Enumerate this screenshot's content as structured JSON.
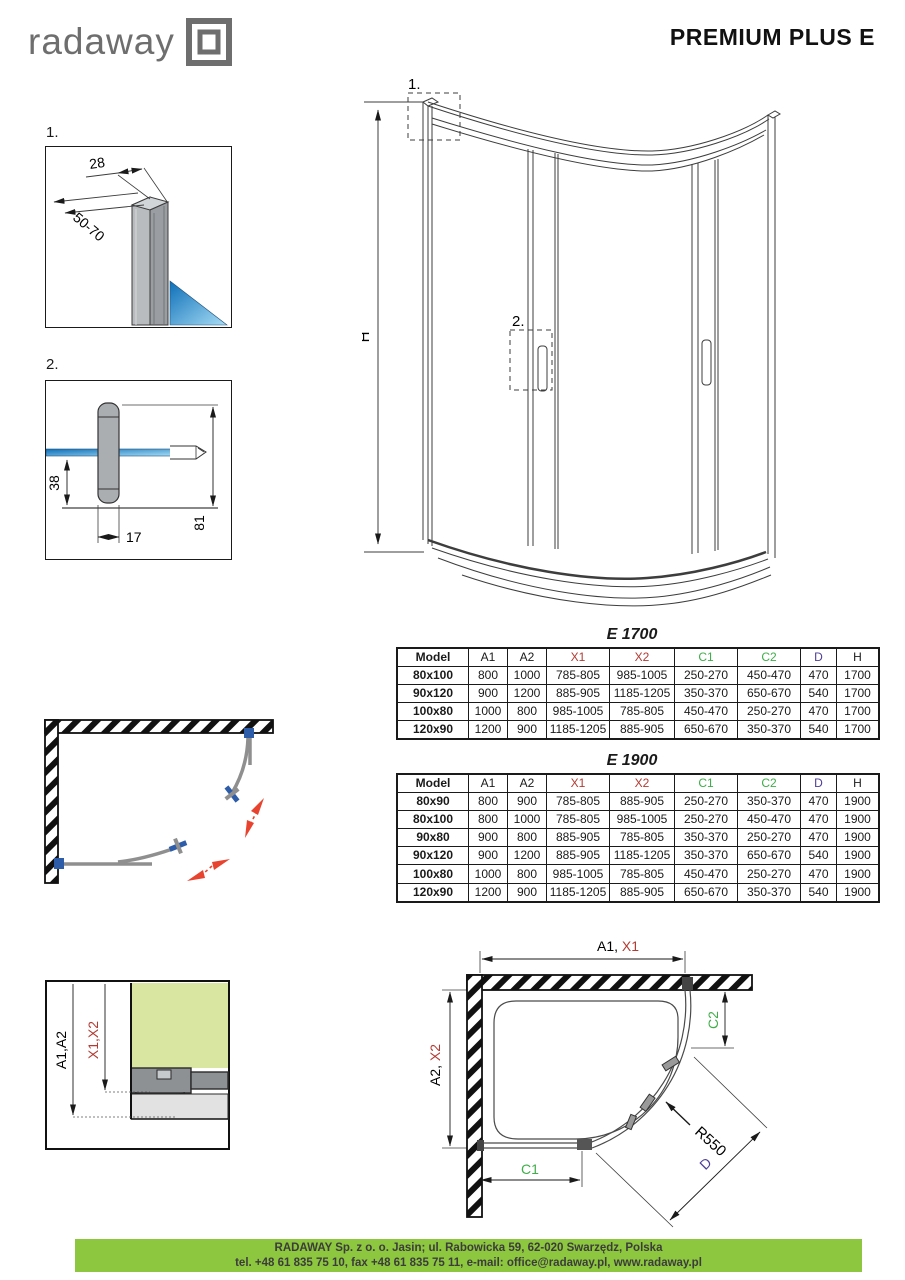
{
  "header": {
    "logo_text": "radaway",
    "title": "PREMIUM PLUS E"
  },
  "figures": {
    "detail1": {
      "label": "1.",
      "dim_width": "28",
      "dim_depth": "50-70"
    },
    "detail2": {
      "label": "2.",
      "dim_a": "38",
      "dim_b": "17",
      "dim_c": "81"
    },
    "elevation": {
      "height": "H",
      "callout1": "1.",
      "callout2": "2."
    },
    "install": {
      "dim_black": "A1,A2",
      "dim_red": "X1,X2"
    },
    "plan_dim": {
      "a1": "A1, ",
      "x1": "X1",
      "a2": "A2, ",
      "x2": "X2",
      "c1": "C1",
      "c2": "C2",
      "radius": "R550",
      "d": "D"
    }
  },
  "tables": [
    {
      "title": "E 1700",
      "columns": [
        "Model",
        "A1",
        "A2",
        "X1",
        "X2",
        "C1",
        "C2",
        "D",
        "H"
      ],
      "column_colors": [
        "#1a1a1a",
        "#1a1a1a",
        "#1a1a1a",
        "#b23b33",
        "#b23b33",
        "#3fae49",
        "#3fae49",
        "#4f3d99",
        "#1a1a1a"
      ],
      "column_widths": [
        70,
        38,
        38,
        62,
        64,
        62,
        62,
        35,
        41
      ],
      "rows": [
        [
          "80x100",
          "800",
          "1000",
          "785-805",
          "985-1005",
          "250-270",
          "450-470",
          "470",
          "1700"
        ],
        [
          "90x120",
          "900",
          "1200",
          "885-905",
          "1185-1205",
          "350-370",
          "650-670",
          "540",
          "1700"
        ],
        [
          "100x80",
          "1000",
          "800",
          "985-1005",
          "785-805",
          "450-470",
          "250-270",
          "470",
          "1700"
        ],
        [
          "120x90",
          "1200",
          "900",
          "1185-1205",
          "885-905",
          "650-670",
          "350-370",
          "540",
          "1700"
        ]
      ]
    },
    {
      "title": "E 1900",
      "columns": [
        "Model",
        "A1",
        "A2",
        "X1",
        "X2",
        "C1",
        "C2",
        "D",
        "H"
      ],
      "column_colors": [
        "#1a1a1a",
        "#1a1a1a",
        "#1a1a1a",
        "#b23b33",
        "#b23b33",
        "#3fae49",
        "#3fae49",
        "#4f3d99",
        "#1a1a1a"
      ],
      "column_widths": [
        70,
        38,
        38,
        62,
        64,
        62,
        62,
        35,
        41
      ],
      "rows": [
        [
          "80x90",
          "800",
          "900",
          "785-805",
          "885-905",
          "250-270",
          "350-370",
          "470",
          "1900"
        ],
        [
          "80x100",
          "800",
          "1000",
          "785-805",
          "985-1005",
          "250-270",
          "450-470",
          "470",
          "1900"
        ],
        [
          "90x80",
          "900",
          "800",
          "885-905",
          "785-805",
          "350-370",
          "250-270",
          "470",
          "1900"
        ],
        [
          "90x120",
          "900",
          "1200",
          "885-905",
          "1185-1205",
          "350-370",
          "650-670",
          "540",
          "1900"
        ],
        [
          "100x80",
          "1000",
          "800",
          "985-1005",
          "785-805",
          "450-470",
          "250-270",
          "470",
          "1900"
        ],
        [
          "120x90",
          "1200",
          "900",
          "1185-1205",
          "885-905",
          "650-670",
          "350-370",
          "540",
          "1900"
        ]
      ]
    }
  ],
  "footer": {
    "line1": "RADAWAY Sp. z o. o. Jasin; ul. Rabowicka 59, 62-020 Swarzędz, Polska",
    "line2": "tel. +48 61 835 75 10, fax +48 61 835 75 11, e-mail: office@radaway.pl, www.radaway.pl"
  },
  "colors": {
    "accent_red": "#b23b33",
    "accent_green": "#3fae49",
    "accent_purple": "#4f3d99",
    "footer_green": "#8dc63f",
    "glass_blue": "#1b75bc",
    "handle_blue": "#2d5da8",
    "arrow_red": "#e8432f",
    "logo_gray": "#6e6e6e"
  }
}
